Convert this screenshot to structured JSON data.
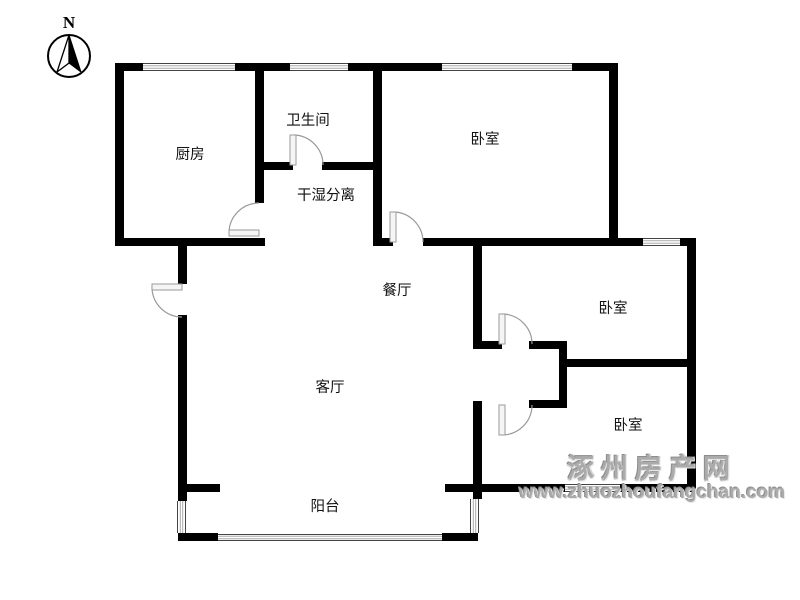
{
  "compass": {
    "label": "N"
  },
  "watermark": {
    "line1": "涿州房产网",
    "line2": "www.zhuozhoufangchan.com"
  },
  "colors": {
    "wall": "#000000",
    "window_edge": "#444444",
    "window_inner": "#aaaaaa",
    "door": "#9a9a9a",
    "door_leaf_fill": "#f5f5f5",
    "label": "#111111"
  },
  "plan": {
    "width": 800,
    "height": 600,
    "rooms": [
      {
        "id": "kitchen",
        "label": "厨房",
        "x": 190,
        "y": 155
      },
      {
        "id": "bathroom",
        "label": "卫生间",
        "x": 308,
        "y": 121
      },
      {
        "id": "wet-area",
        "label": "干湿分离",
        "x": 326,
        "y": 196
      },
      {
        "id": "bedroom-1",
        "label": "卧室",
        "x": 485,
        "y": 140
      },
      {
        "id": "dining",
        "label": "餐厅",
        "x": 397,
        "y": 291
      },
      {
        "id": "living",
        "label": "客厅",
        "x": 330,
        "y": 388
      },
      {
        "id": "bedroom-2",
        "label": "卧室",
        "x": 613,
        "y": 309
      },
      {
        "id": "bedroom-3",
        "label": "卧室",
        "x": 628,
        "y": 426
      },
      {
        "id": "balcony",
        "label": "阳台",
        "x": 325,
        "y": 507
      }
    ],
    "walls": [
      [
        115,
        63,
        503,
        8
      ],
      [
        115,
        63,
        9,
        183
      ],
      [
        115,
        238,
        150,
        8
      ],
      [
        255,
        63,
        9,
        140
      ],
      [
        255,
        162,
        38,
        8
      ],
      [
        322,
        162,
        60,
        8
      ],
      [
        373,
        63,
        9,
        183
      ],
      [
        609,
        63,
        9,
        183
      ],
      [
        373,
        238,
        20,
        8
      ],
      [
        423,
        238,
        272,
        8
      ],
      [
        687,
        238,
        9,
        254
      ],
      [
        178,
        246,
        9,
        38
      ],
      [
        178,
        315,
        9,
        186
      ],
      [
        473,
        246,
        9,
        99
      ],
      [
        473,
        401,
        9,
        98
      ],
      [
        473,
        341,
        29,
        8
      ],
      [
        529,
        341,
        38,
        8
      ],
      [
        559,
        341,
        8,
        67
      ],
      [
        529,
        400,
        38,
        8
      ],
      [
        559,
        359,
        136,
        8
      ],
      [
        178,
        484,
        42,
        8
      ],
      [
        445,
        484,
        45,
        8
      ],
      [
        481,
        484,
        84,
        8
      ],
      [
        620,
        484,
        75,
        8
      ],
      [
        178,
        533,
        40,
        8
      ],
      [
        442,
        533,
        36,
        8
      ]
    ],
    "windows": [
      {
        "x": 143,
        "y": 63,
        "w": 92,
        "h": 8,
        "dir": "h"
      },
      {
        "x": 290,
        "y": 63,
        "w": 58,
        "h": 8,
        "dir": "h"
      },
      {
        "x": 442,
        "y": 63,
        "w": 130,
        "h": 8,
        "dir": "h"
      },
      {
        "x": 643,
        "y": 238,
        "w": 37,
        "h": 8,
        "dir": "h"
      },
      {
        "x": 565,
        "y": 484,
        "w": 55,
        "h": 8,
        "dir": "h"
      },
      {
        "x": 177,
        "y": 501,
        "w": 9,
        "h": 32,
        "dir": "v"
      },
      {
        "x": 470,
        "y": 499,
        "w": 9,
        "h": 34,
        "dir": "v"
      },
      {
        "x": 218,
        "y": 534,
        "w": 224,
        "h": 7,
        "dir": "h"
      }
    ],
    "doors": [
      {
        "id": "kitchen-door",
        "leaf": [
          229,
          230,
          30,
          6
        ],
        "tip": [
          229,
          233
        ],
        "closed": [
          259,
          203
        ],
        "r": 30,
        "sweep": 1
      },
      {
        "id": "bathroom-door",
        "leaf": [
          290,
          135,
          6,
          30
        ],
        "tip": [
          293,
          135
        ],
        "closed": [
          323,
          165
        ],
        "r": 30,
        "sweep": 1
      },
      {
        "id": "bedroom-1-door",
        "leaf": [
          390,
          212,
          6,
          30
        ],
        "tip": [
          393,
          212
        ],
        "closed": [
          423,
          242
        ],
        "r": 30,
        "sweep": 1
      },
      {
        "id": "entry-door",
        "leaf": [
          152,
          284,
          30,
          6
        ],
        "tip": [
          152,
          287
        ],
        "closed": [
          182,
          317
        ],
        "r": 30,
        "sweep": 0
      },
      {
        "id": "bedroom-2-door",
        "leaf": [
          499,
          314,
          6,
          30
        ],
        "tip": [
          502,
          314
        ],
        "closed": [
          532,
          344
        ],
        "r": 30,
        "sweep": 1
      },
      {
        "id": "bedroom-3-door",
        "leaf": [
          499,
          405,
          6,
          30
        ],
        "tip": [
          502,
          435
        ],
        "closed": [
          532,
          405
        ],
        "r": 30,
        "sweep": 0
      }
    ]
  }
}
